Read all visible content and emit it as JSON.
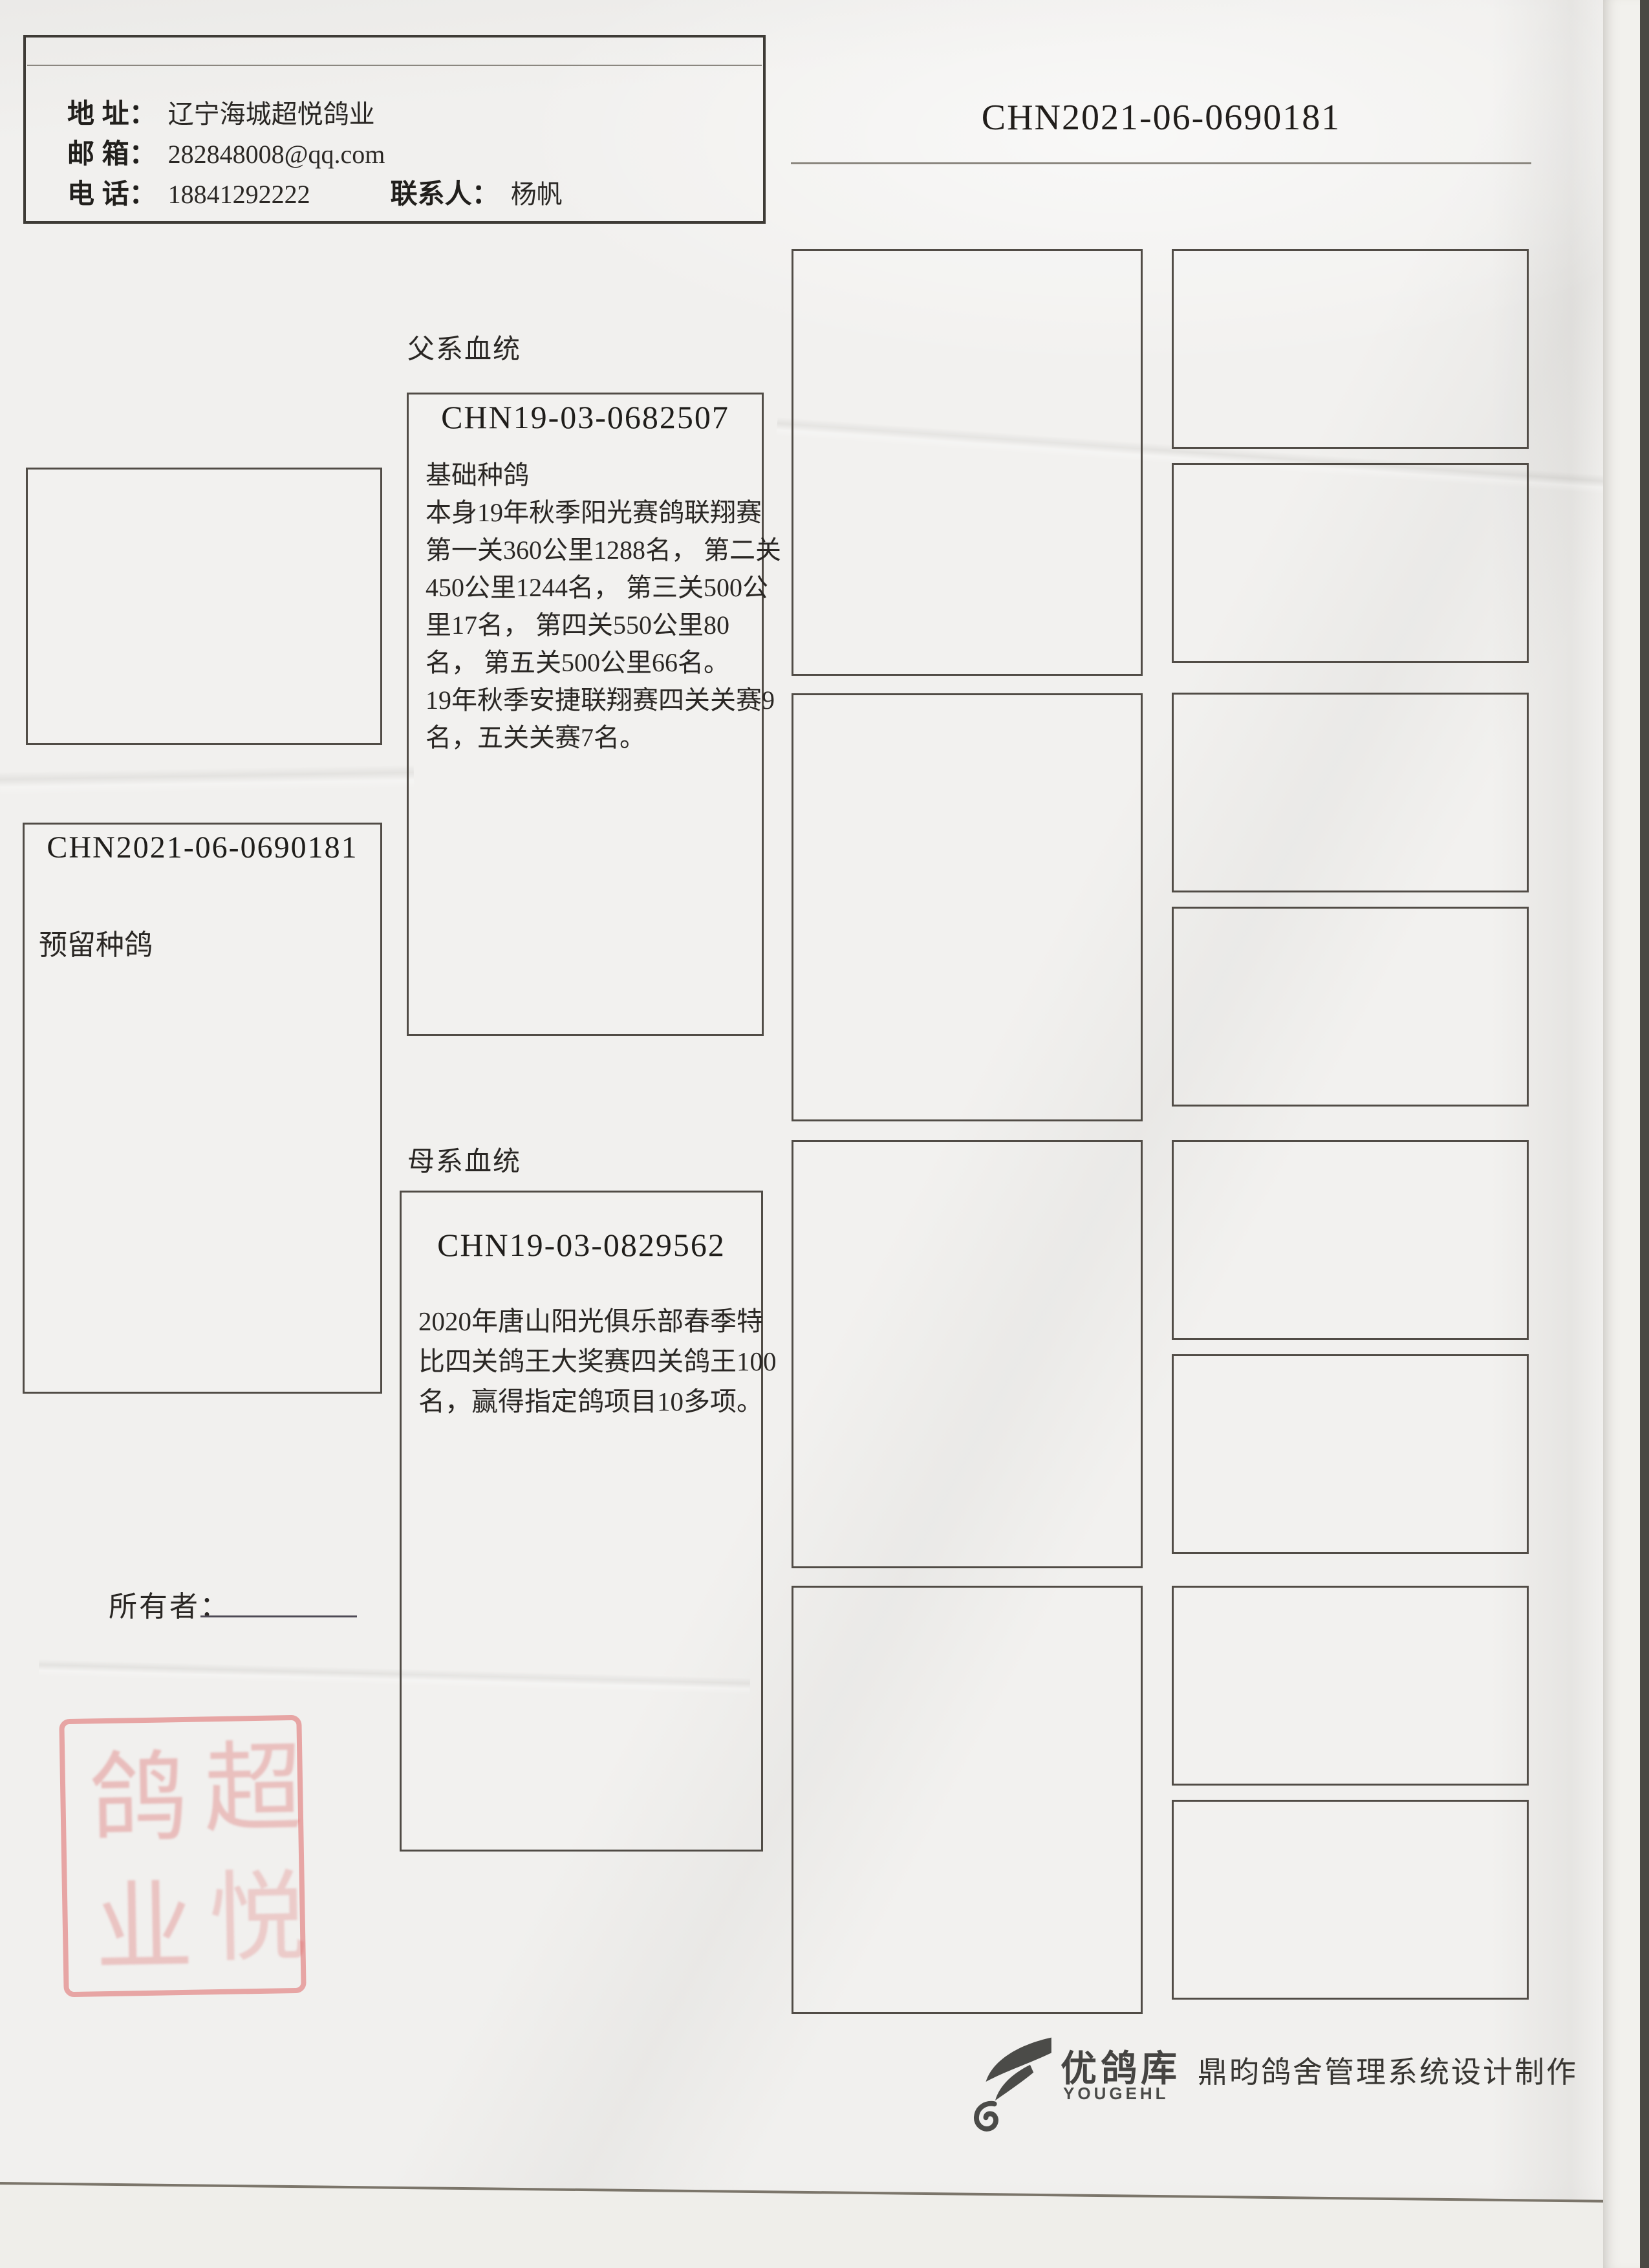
{
  "header": {
    "ring_id": "CHN2021-06-0690181"
  },
  "contact": {
    "address_label": "地 址：",
    "address_value": "辽宁海城超悦鸽业",
    "email_label": "邮 箱：",
    "email_value": "282848008@qq.com",
    "phone_label": "电 话：",
    "phone_value": "18841292222",
    "person_label": "联系人：",
    "person_value": "杨帆"
  },
  "sections": {
    "sire_label": "父系血统",
    "dam_label": "母系血统"
  },
  "subject": {
    "ring_number": "CHN2021-06-0690181",
    "note": "预留种鸽"
  },
  "sire": {
    "ring_number": "CHN19-03-0682507",
    "lines": [
      "基础种鸽",
      "本身19年秋季阳光赛鸽联翔赛",
      "第一关360公里1288名， 第二关",
      "450公里1244名， 第三关500公",
      "里17名，  第四关550公里80",
      "名，  第五关500公里66名。",
      "19年秋季安捷联翔赛四关关赛9",
      "名，五关关赛7名。"
    ]
  },
  "dam": {
    "ring_number": "CHN19-03-0829562",
    "lines": [
      "2020年唐山阳光俱乐部春季特",
      "比四关鸽王大奖赛四关鸽王100",
      "名，赢得指定鸽项目10多项。"
    ]
  },
  "owner": {
    "label": "所有者："
  },
  "stamp": {
    "char_top_left": "鸽",
    "char_top_right": "超",
    "char_bottom_left": "业",
    "char_bottom_right": "悦",
    "color": "#d95c5c"
  },
  "footer": {
    "brand_name": "优鸽库",
    "brand_latin": "YOUGEHL",
    "credit": "鼎昀鸽舍管理系统设计制作"
  },
  "colors": {
    "paper": "#f1f0ee",
    "box_border": "#514c46",
    "text": "#262320",
    "stamp_red": "#d95c5c"
  }
}
